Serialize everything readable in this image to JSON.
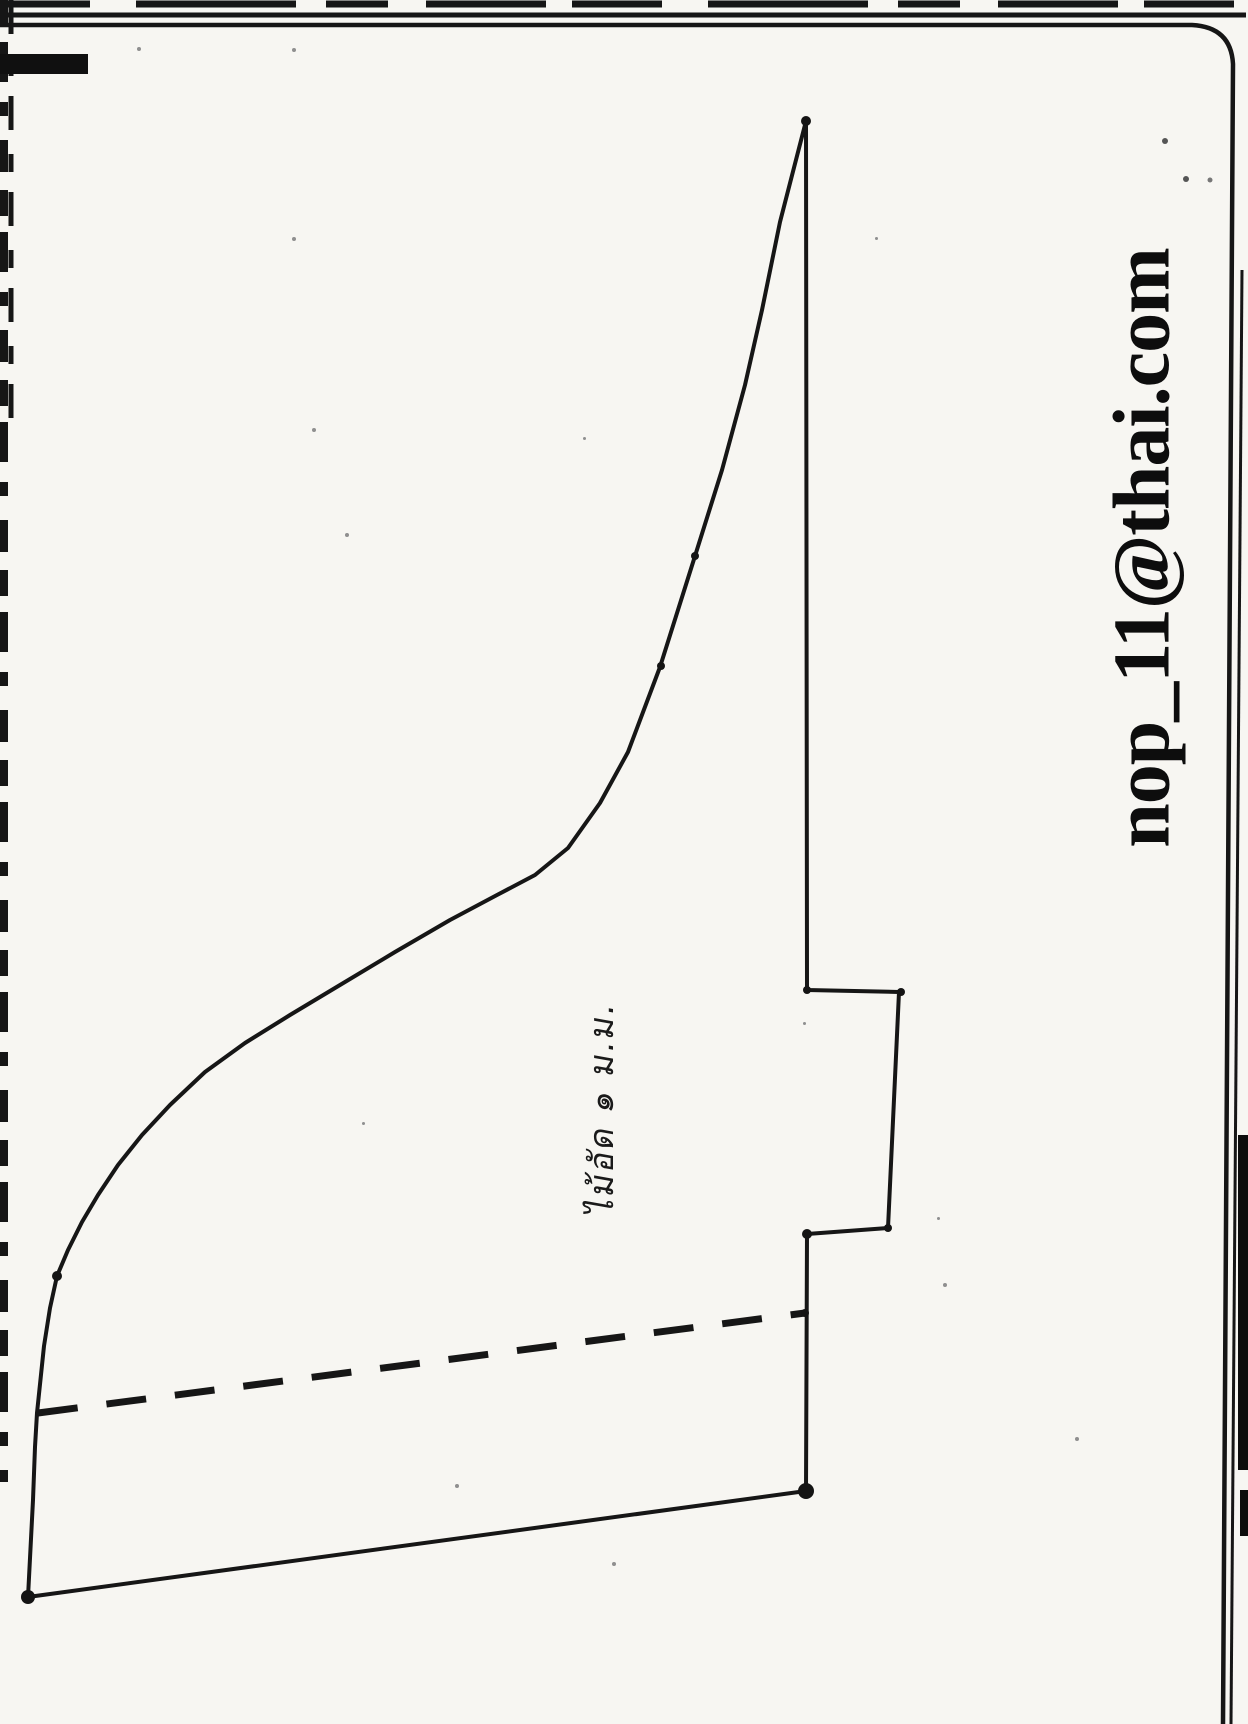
{
  "page": {
    "paper_color": "#f7f6f2",
    "ink_color": "#161616"
  },
  "watermark": {
    "text": "nop_11@thai.com",
    "orientation": "rotated-90-ccw"
  },
  "annotation": {
    "text": "ไม้อัด ๑ ม.ม.",
    "meaning": "plywood 1 mm",
    "orientation": "rotated-90-ccw"
  },
  "pattern": {
    "description": "hand-drawn pattern template outline",
    "outline_points": [
      [
        806,
        121
      ],
      [
        807,
        990
      ],
      [
        899,
        992
      ],
      [
        888,
        1228
      ],
      [
        807,
        1234
      ],
      [
        806,
        1491
      ],
      [
        28,
        1597
      ],
      [
        33,
        1500
      ],
      [
        35,
        1447
      ],
      [
        37,
        1413
      ],
      [
        44,
        1346
      ],
      [
        50,
        1308
      ],
      [
        57,
        1276
      ],
      [
        68,
        1250
      ],
      [
        82,
        1222
      ],
      [
        98,
        1195
      ],
      [
        118,
        1165
      ],
      [
        142,
        1135
      ],
      [
        170,
        1105
      ],
      [
        205,
        1072
      ],
      [
        245,
        1043
      ],
      [
        290,
        1015
      ],
      [
        340,
        985
      ],
      [
        395,
        952
      ],
      [
        450,
        920
      ],
      [
        497,
        895
      ],
      [
        535,
        875
      ],
      [
        568,
        848
      ],
      [
        600,
        803
      ],
      [
        628,
        752
      ],
      [
        660,
        667
      ],
      [
        695,
        556
      ],
      [
        722,
        470
      ],
      [
        745,
        385
      ],
      [
        762,
        310
      ],
      [
        780,
        222
      ],
      [
        806,
        121
      ]
    ],
    "fold_line": {
      "from": [
        38,
        1413
      ],
      "to": [
        805,
        1313
      ],
      "style": "dashed"
    },
    "reference_dots": [
      [
        806,
        121,
        5
      ],
      [
        807,
        990,
        4
      ],
      [
        901,
        992,
        4
      ],
      [
        888,
        1228,
        4
      ],
      [
        807,
        1234,
        5
      ],
      [
        806,
        1491,
        8
      ],
      [
        28,
        1597,
        7
      ],
      [
        57,
        1276,
        5
      ],
      [
        695,
        556,
        4
      ],
      [
        661,
        666,
        4
      ],
      [
        805,
        1313,
        4
      ]
    ]
  }
}
